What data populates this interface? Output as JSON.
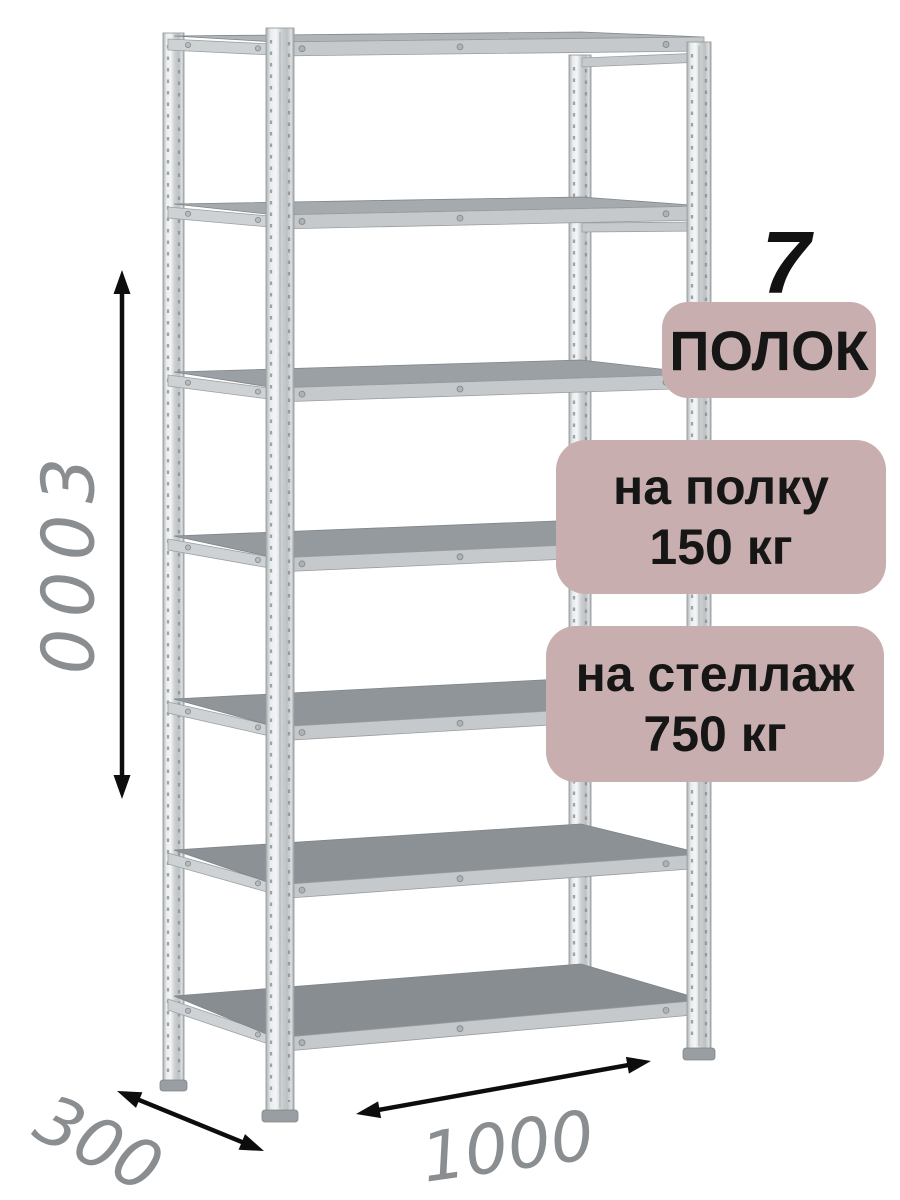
{
  "product": {
    "shelf_count": "7",
    "shelf_count_label": "ПОЛОК",
    "per_shelf_load_line1": "на полку",
    "per_shelf_load_line2": "150 кг",
    "per_rack_load_line1": "на стеллаж",
    "per_rack_load_line2": "750 кг"
  },
  "dimensions": {
    "height_mm": "3000",
    "depth_mm": "300",
    "width_mm": "1000"
  },
  "colors": {
    "badge_bg": "#c8aeae",
    "badge_text": "#161616",
    "dimension_text": "#8a8e91",
    "arrow": "#0d0d0d",
    "metal_light": "#eef0f1",
    "metal_mid": "#c6cacc",
    "shelf_top": "#8d9296",
    "background": "#ffffff"
  }
}
